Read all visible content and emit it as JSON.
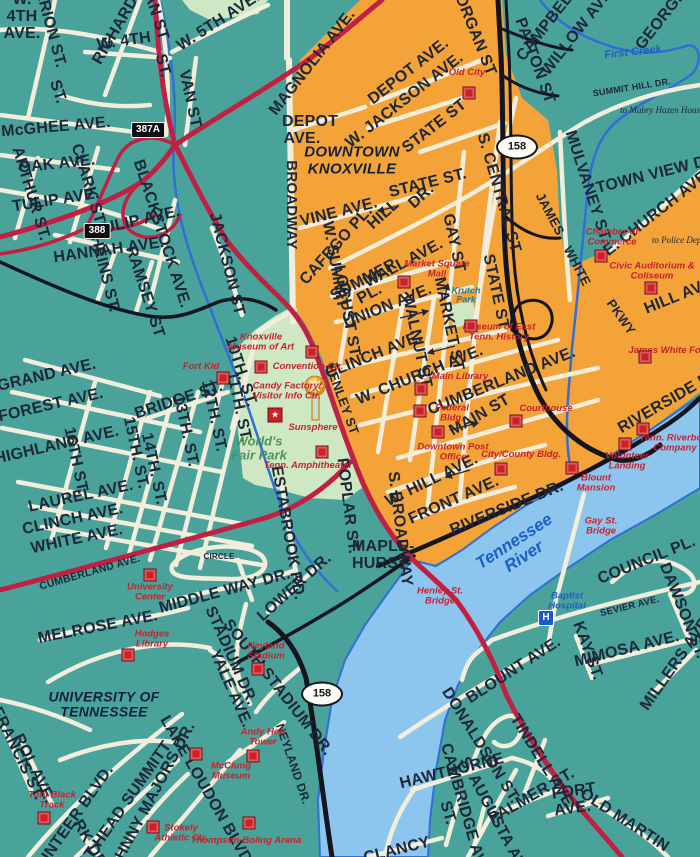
{
  "map_title": "Downtown Knoxville street map",
  "colors": {
    "background_teal": "#4aa39b",
    "downtown_orange": "#f4a339",
    "park_green": "#cfe8c4",
    "river_blue": "#8cc6ee",
    "water_line": "#2f6fd6",
    "road_cream": "#f2eedb",
    "road_red": "#c22043",
    "road_black": "#15151f",
    "label_dark": "#1e2737",
    "label_red": "#c5232e",
    "label_blue": "#1d5fc4",
    "krutch_teal": "#16808f",
    "wfp_green": "#4e9359"
  },
  "icons": {
    "hospital_letter": "H",
    "visitor_star": "★"
  },
  "areas": [
    {
      "t": "DOWNTOWN KNOXVILLE",
      "x": 352,
      "y": 161,
      "s": 15,
      "w": 104
    },
    {
      "t": "UNIVERSITY OF TENNESSEE",
      "x": 104,
      "y": 705,
      "s": 14,
      "w": 160
    }
  ],
  "parks": [
    {
      "t": "World's Fair Park",
      "x": 259,
      "y": 448,
      "s": 13,
      "w": 56,
      "c": "#4e9359"
    },
    {
      "t": "Krutch Park",
      "x": 466,
      "y": 296,
      "s": 9,
      "w": 40,
      "c": "#16808f"
    }
  ],
  "water": [
    {
      "t": "Tennessee River",
      "x": 519,
      "y": 549,
      "s": 17,
      "r": -33,
      "w": 112
    },
    {
      "t": "First Creek",
      "x": 633,
      "y": 53,
      "s": 11,
      "r": -6,
      "w": 120
    }
  ],
  "notes": [
    {
      "t": "to Mabry Hazen House",
      "x": 662,
      "y": 110,
      "w": 84
    },
    {
      "t": "to Police Dept.",
      "x": 679,
      "y": 240,
      "w": 58
    }
  ],
  "shields": [
    {
      "t": "387A",
      "type": "rect",
      "x": 148,
      "y": 130
    },
    {
      "t": "388",
      "type": "rect",
      "x": 97,
      "y": 231
    },
    {
      "t": "158",
      "type": "oval",
      "x": 517,
      "y": 147
    },
    {
      "t": "158",
      "type": "oval",
      "x": 322,
      "y": 694
    }
  ],
  "landmarks": [
    {
      "t": "Old City",
      "x": 467,
      "y": 73,
      "w": 60,
      "sq": [
        469,
        93
      ]
    },
    {
      "t": "Market Square Mall",
      "x": 437,
      "y": 270,
      "w": 80,
      "sq": [
        404,
        282
      ]
    },
    {
      "t": "Chamber of Commerce",
      "x": 612,
      "y": 238,
      "w": 90,
      "sq": [
        601,
        256
      ]
    },
    {
      "t": "Civic Auditorium & Coliseum",
      "x": 652,
      "y": 272,
      "w": 110,
      "sq": [
        651,
        288
      ]
    },
    {
      "t": "Museum of East Tenn. History",
      "x": 499,
      "y": 333,
      "w": 88,
      "sq": [
        471,
        326
      ]
    },
    {
      "t": "James White Fort",
      "x": 668,
      "y": 351,
      "w": 80,
      "sq": [
        645,
        357
      ]
    },
    {
      "t": "Main Library",
      "x": 460,
      "y": 377,
      "w": 90,
      "sq": [
        421,
        389
      ]
    },
    {
      "t": "Federal Bldg.",
      "x": 452,
      "y": 414,
      "w": 56,
      "sq": [
        420,
        411
      ]
    },
    {
      "t": "Downtown Post Office",
      "x": 453,
      "y": 453,
      "w": 88,
      "sq": [
        438,
        432
      ]
    },
    {
      "t": "Courthouse",
      "x": 546,
      "y": 409,
      "w": 90,
      "sq": [
        516,
        421
      ]
    },
    {
      "t": "City/County Bldg.",
      "x": 521,
      "y": 455,
      "w": 80,
      "sq": [
        501,
        469
      ]
    },
    {
      "t": "Blount Mansion",
      "x": 596,
      "y": 484,
      "w": 66,
      "sq": [
        572,
        468
      ]
    },
    {
      "t": "Volunteer Landing",
      "x": 627,
      "y": 462,
      "w": 78,
      "sq": [
        625,
        444
      ]
    },
    {
      "t": "Tenn. Riverboat Company",
      "x": 675,
      "y": 444,
      "w": 80,
      "sq": [
        643,
        429
      ]
    },
    {
      "t": "Knoxville Museum of Art",
      "x": 261,
      "y": 343,
      "w": 78,
      "sq": [
        261,
        367
      ]
    },
    {
      "t": "Fort Kid",
      "x": 201,
      "y": 367,
      "w": 60,
      "sq": [
        223,
        378
      ]
    },
    {
      "t": "Convention Ctr.",
      "x": 308,
      "y": 367,
      "w": 80,
      "sq": [
        312,
        352
      ]
    },
    {
      "t": "Candy Factory/ Visitor Info Ctr.",
      "x": 287,
      "y": 392,
      "w": 96
    },
    {
      "t": "Sunsphere",
      "x": 313,
      "y": 428,
      "w": 80
    },
    {
      "t": "Tenn. Amphitheater",
      "x": 308,
      "y": 466,
      "w": 90,
      "sq": [
        322,
        452
      ]
    },
    {
      "t": "University Center",
      "x": 150,
      "y": 593,
      "w": 68,
      "sq": [
        150,
        575
      ]
    },
    {
      "t": "Hodges Library",
      "x": 152,
      "y": 640,
      "w": 56,
      "sq": [
        128,
        655
      ]
    },
    {
      "t": "Neyland Stadium",
      "x": 266,
      "y": 652,
      "w": 64,
      "sq": [
        258,
        669
      ]
    },
    {
      "t": "Andy Holt Tower",
      "x": 263,
      "y": 738,
      "w": 64,
      "sq": [
        253,
        756
      ]
    },
    {
      "t": "McClung Museum",
      "x": 231,
      "y": 772,
      "w": 66,
      "sq": [
        196,
        754
      ]
    },
    {
      "t": "Stokely Athletic Ctr.",
      "x": 181,
      "y": 834,
      "w": 58,
      "sq": [
        153,
        827
      ]
    },
    {
      "t": "Thompson-Boling Arena",
      "x": 246,
      "y": 841,
      "w": 120,
      "sq": [
        249,
        823
      ]
    },
    {
      "t": "Tom Black Track",
      "x": 52,
      "y": 801,
      "w": 66,
      "sq": [
        44,
        818
      ]
    },
    {
      "t": "Henley St. Bridge",
      "x": 440,
      "y": 597,
      "w": 66
    },
    {
      "t": "Gay St. Bridge",
      "x": 601,
      "y": 527,
      "w": 56
    }
  ],
  "hospital": {
    "t": "Baptist Hospital",
    "x": 567,
    "y": 602,
    "w": 62,
    "icon": [
      546,
      618
    ]
  },
  "streets": [
    {
      "t": "W. 4TH AVE.",
      "x": 22,
      "y": 17,
      "r": 0,
      "w": 40
    },
    {
      "t": "MARION ST.",
      "x": 48,
      "y": 22,
      "r": 75
    },
    {
      "t": "RICHARDS ST.",
      "x": 126,
      "y": 14,
      "r": -60
    },
    {
      "t": "VAN ST",
      "x": 154,
      "y": 12,
      "r": 72
    },
    {
      "t": "W. 4TH",
      "x": 124,
      "y": 42,
      "r": -8
    },
    {
      "t": "ST.",
      "x": 162,
      "y": 66,
      "r": 75
    },
    {
      "t": "W. 5TH AVE.",
      "x": 219,
      "y": 22,
      "r": -33
    },
    {
      "t": "VAN ST",
      "x": 189,
      "y": 99,
      "r": 78
    },
    {
      "t": "MAGNOLIA AVE.",
      "x": 313,
      "y": 63,
      "r": -52
    },
    {
      "t": "McGHEE AVE.",
      "x": 56,
      "y": 128,
      "r": -5
    },
    {
      "t": "ST.",
      "x": 57,
      "y": 92,
      "r": 72
    },
    {
      "t": "OAK AVE.",
      "x": 57,
      "y": 165,
      "r": -6
    },
    {
      "t": "ARTHUR ST.",
      "x": 30,
      "y": 194,
      "r": 73
    },
    {
      "t": "TULIP AVE.",
      "x": 56,
      "y": 201,
      "r": -9
    },
    {
      "t": "CLARK ST",
      "x": 87,
      "y": 184,
      "r": 73
    },
    {
      "t": "TULIP AVE.",
      "x": 137,
      "y": 222,
      "r": -13
    },
    {
      "t": "HANNAH AVE.",
      "x": 109,
      "y": 251,
      "r": -8
    },
    {
      "t": "HEINS ST.",
      "x": 104,
      "y": 274,
      "r": 76
    },
    {
      "t": "RAMSEY ST",
      "x": 144,
      "y": 292,
      "r": 72
    },
    {
      "t": "BLACKSTOCK AVE.",
      "x": 161,
      "y": 234,
      "r": 72
    },
    {
      "t": "JACKSON ST",
      "x": 226,
      "y": 264,
      "r": 76
    },
    {
      "t": "GRAND AVE.",
      "x": 47,
      "y": 376,
      "r": -13
    },
    {
      "t": "FOREST AVE.",
      "x": 51,
      "y": 406,
      "r": -13
    },
    {
      "t": "HIGHLAND AVE.",
      "x": 57,
      "y": 446,
      "r": -13
    },
    {
      "t": "16TH ST.",
      "x": 75,
      "y": 461,
      "r": 78
    },
    {
      "t": "15TH. ST.",
      "x": 135,
      "y": 453,
      "r": 78
    },
    {
      "t": "14TH. ST.",
      "x": 153,
      "y": 469,
      "r": 78
    },
    {
      "t": "13TH. ST.",
      "x": 185,
      "y": 431,
      "r": 78
    },
    {
      "t": "12TH. ST.",
      "x": 213,
      "y": 416,
      "r": 78
    },
    {
      "t": "11TH. ST.",
      "x": 238,
      "y": 407,
      "r": 78
    },
    {
      "t": "10TH. ST.",
      "x": 240,
      "y": 372,
      "r": 72
    },
    {
      "t": "BRIDGE ST.",
      "x": 179,
      "y": 401,
      "r": -18
    },
    {
      "t": "LAUREL AVE.",
      "x": 81,
      "y": 497,
      "r": -12
    },
    {
      "t": "CLINCH AVE.",
      "x": 73,
      "y": 520,
      "r": -12
    },
    {
      "t": "WHITE AVE.",
      "x": 77,
      "y": 540,
      "r": -12
    },
    {
      "t": "CUMBERLAND AVE.",
      "x": 90,
      "y": 573,
      "r": -16,
      "s": 10.5
    },
    {
      "t": "MORGAN ST",
      "x": 472,
      "y": 29,
      "r": 68
    },
    {
      "t": "DEPOT AVE.",
      "x": 302,
      "y": 131,
      "r": 0,
      "w": 40
    },
    {
      "t": "DEPOT AVE.",
      "x": 409,
      "y": 72,
      "r": -38
    },
    {
      "t": "W. JACKSON AVE.",
      "x": 405,
      "y": 101,
      "r": -38
    },
    {
      "t": "STATE ST",
      "x": 435,
      "y": 127,
      "r": -38
    },
    {
      "t": "STATE ST.",
      "x": 428,
      "y": 184,
      "r": -14
    },
    {
      "t": "S. CENTRAL ST",
      "x": 498,
      "y": 193,
      "r": 74
    },
    {
      "t": "GAY ST",
      "x": 453,
      "y": 243,
      "r": 78
    },
    {
      "t": "STATE ST",
      "x": 495,
      "y": 292,
      "r": 78
    },
    {
      "t": "W. SUMMIT",
      "x": 334,
      "y": 265,
      "r": 80
    },
    {
      "t": "HILL",
      "x": 384,
      "y": 215,
      "r": -42
    },
    {
      "t": "DR.",
      "x": 422,
      "y": 197,
      "r": -42
    },
    {
      "t": "VINE AVE.",
      "x": 339,
      "y": 213,
      "r": -14
    },
    {
      "t": "CAFEGO PL.",
      "x": 337,
      "y": 246,
      "r": -48
    },
    {
      "t": "SUMMER",
      "x": 364,
      "y": 281,
      "r": -28
    },
    {
      "t": "PL.",
      "x": 370,
      "y": 295,
      "r": -28
    },
    {
      "t": "WALL AVE.",
      "x": 404,
      "y": 264,
      "r": -28
    },
    {
      "t": "LOCUST ST",
      "x": 346,
      "y": 311,
      "r": 80
    },
    {
      "t": "UNION AVE.",
      "x": 388,
      "y": 307,
      "r": -22
    },
    {
      "t": "WALNUT ST",
      "x": 416,
      "y": 341,
      "r": 78
    },
    {
      "t": "MARKET ST",
      "x": 448,
      "y": 324,
      "r": 78
    },
    {
      "t": "CLINCH AVE.",
      "x": 374,
      "y": 356,
      "r": -22
    },
    {
      "t": "W. CHURCH AVE.",
      "x": 420,
      "y": 376,
      "r": -22
    },
    {
      "t": "CUMBERLAND AVE.",
      "x": 502,
      "y": 382,
      "r": -22
    },
    {
      "t": "MAIN ST",
      "x": 480,
      "y": 416,
      "r": -30
    },
    {
      "t": "W. HILL AVE.",
      "x": 432,
      "y": 481,
      "r": -26
    },
    {
      "t": "FRONT AVE.",
      "x": 454,
      "y": 501,
      "r": -24
    },
    {
      "t": "RIVERSIDE DR.",
      "x": 507,
      "y": 509,
      "r": -22
    },
    {
      "t": "RIVERSIDE DR.",
      "x": 672,
      "y": 400,
      "r": -30
    },
    {
      "t": "S. BROADWAY",
      "x": 399,
      "y": 529,
      "r": 83
    },
    {
      "t": "POPLAR ST.",
      "x": 347,
      "y": 506,
      "r": 83
    },
    {
      "t": "MAPLE-HURST",
      "x": 374,
      "y": 556,
      "r": 0,
      "w": 44
    },
    {
      "t": "BROADWAY",
      "x": 291,
      "y": 205,
      "r": 90,
      "s": 15
    },
    {
      "t": "HENLEY ST",
      "x": 342,
      "y": 399,
      "r": 70,
      "s": 13
    },
    {
      "t": "JAMES",
      "x": 550,
      "y": 214,
      "r": 62,
      "s": 13
    },
    {
      "t": "WHITE",
      "x": 577,
      "y": 266,
      "r": 62,
      "s": 13
    },
    {
      "t": "PKWY",
      "x": 621,
      "y": 317,
      "r": 55,
      "s": 13
    },
    {
      "t": "MULVANEY ST.",
      "x": 587,
      "y": 187,
      "r": 72
    },
    {
      "t": "TOWN VIEW DR.",
      "x": 659,
      "y": 174,
      "r": -14
    },
    {
      "t": "SUMMIT HILL DR.",
      "x": 632,
      "y": 88,
      "r": -9,
      "s": 9
    },
    {
      "t": "E. CHURCH AVE.",
      "x": 658,
      "y": 213,
      "r": -38
    },
    {
      "t": "HILL AVE.",
      "x": 681,
      "y": 296,
      "r": -22
    },
    {
      "t": "CAMPBELL AVE.",
      "x": 561,
      "y": 8,
      "r": -52
    },
    {
      "t": "WILLOW AVE.",
      "x": 579,
      "y": 31,
      "r": -52
    },
    {
      "t": "GEORGIA ST.",
      "x": 672,
      "y": 7,
      "r": -52
    },
    {
      "t": "PATTON ST",
      "x": 534,
      "y": 61,
      "r": 70
    },
    {
      "t": "SEVIER AVE.",
      "x": 630,
      "y": 607,
      "r": -14,
      "s": 9.5
    },
    {
      "t": "DAWSON ST.",
      "x": 682,
      "y": 611,
      "r": 68
    },
    {
      "t": "COUNCIL PL.",
      "x": 647,
      "y": 561,
      "r": -22
    },
    {
      "t": "KAY ST.",
      "x": 587,
      "y": 651,
      "r": 70
    },
    {
      "t": "MIMOSA AVE.",
      "x": 627,
      "y": 650,
      "r": -14
    },
    {
      "t": "MILLERS AVE.",
      "x": 677,
      "y": 663,
      "r": -55
    },
    {
      "t": "BLOUNT AVE.",
      "x": 514,
      "y": 671,
      "r": -33
    },
    {
      "t": "HAWTHORNE",
      "x": 452,
      "y": 772,
      "r": -14
    },
    {
      "t": "DONALDSON ST.",
      "x": 480,
      "y": 746,
      "r": 58
    },
    {
      "t": "TINDELL AVE.",
      "x": 542,
      "y": 763,
      "r": 58
    },
    {
      "t": "CAMBRIDGE AVE.",
      "x": 464,
      "y": 812,
      "r": 74
    },
    {
      "t": "ST.",
      "x": 447,
      "y": 813,
      "r": 74
    },
    {
      "t": "S. AUGUSTA AVE.",
      "x": 495,
      "y": 820,
      "r": 62
    },
    {
      "t": "PALMER ST.",
      "x": 532,
      "y": 797,
      "r": -30
    },
    {
      "t": "FORT AVE.",
      "x": 571,
      "y": 801,
      "r": -8,
      "w": 36
    },
    {
      "t": "OLD MARTIN",
      "x": 624,
      "y": 821,
      "r": 33
    },
    {
      "t": "CLANCY",
      "x": 397,
      "y": 851,
      "r": -14
    },
    {
      "t": "MELROSE AVE.",
      "x": 98,
      "y": 628,
      "r": -11
    },
    {
      "t": "CIRCLE",
      "x": 219,
      "y": 557,
      "r": 0,
      "s": 8
    },
    {
      "t": "MIDDLE WAY DR.",
      "x": 225,
      "y": 592,
      "r": -15
    },
    {
      "t": "LOWER DR.",
      "x": 295,
      "y": 588,
      "r": -42
    },
    {
      "t": "STADIUM DR.",
      "x": 230,
      "y": 656,
      "r": 66
    },
    {
      "t": "YALE AVE.",
      "x": 230,
      "y": 689,
      "r": 66
    },
    {
      "t": "SOUTH STADIUM DR.",
      "x": 277,
      "y": 688,
      "r": 52
    },
    {
      "t": "NEYLAND DR.",
      "x": 293,
      "y": 764,
      "r": 71,
      "s": 12
    },
    {
      "t": "ESTABROOK RD.",
      "x": 287,
      "y": 533,
      "r": 80
    },
    {
      "t": "LAKE LOUDON BLVD",
      "x": 205,
      "y": 790,
      "r": 60
    },
    {
      "t": "JOHNNY MAJORS DR.",
      "x": 151,
      "y": 801,
      "r": -62
    },
    {
      "t": "PAT HEAD SUMMITT",
      "x": 123,
      "y": 809,
      "r": -55
    },
    {
      "t": "VOLUNTEER BLVD.",
      "x": 67,
      "y": 830,
      "r": -55
    },
    {
      "t": "FRANCIS ST.",
      "x": 17,
      "y": 754,
      "r": 64
    },
    {
      "t": "ROL AVE.",
      "x": 33,
      "y": 769,
      "r": 64
    },
    {
      "t": "RK DR.",
      "x": 90,
      "y": 846,
      "r": 60
    }
  ]
}
